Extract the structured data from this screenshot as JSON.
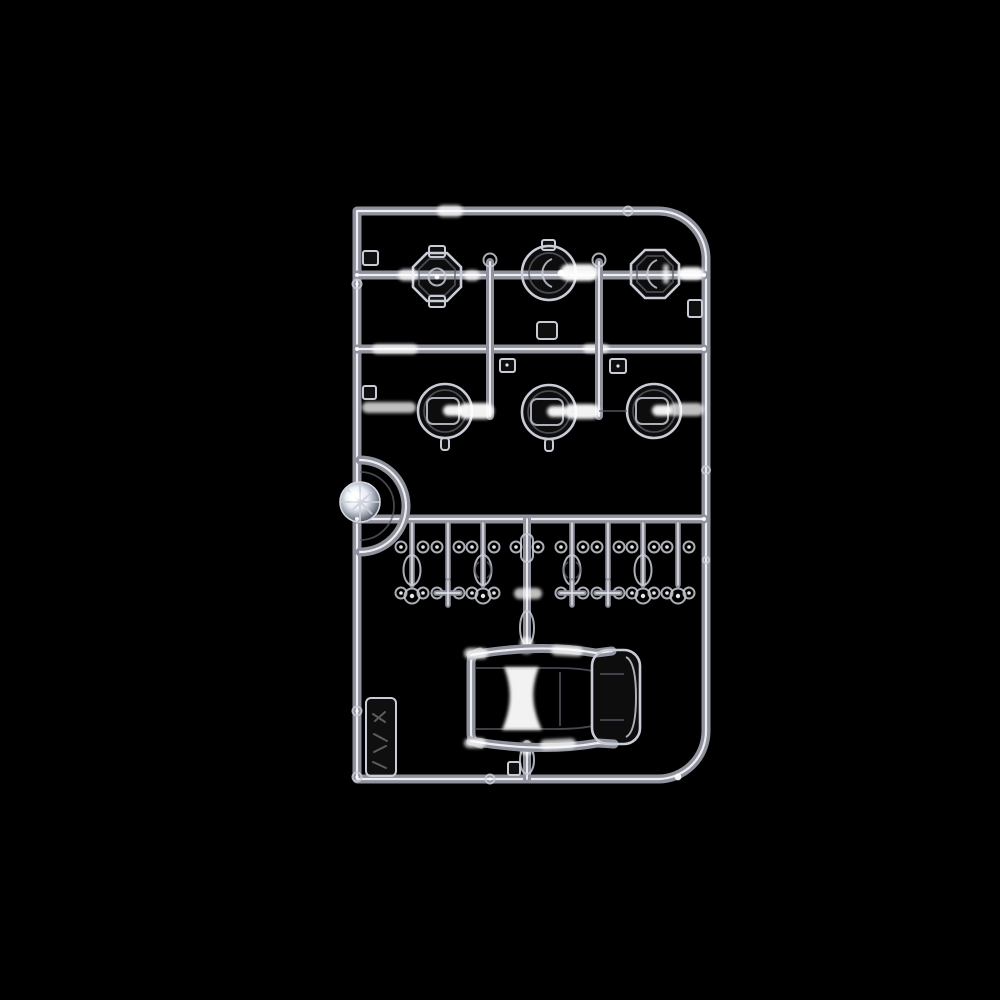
{
  "meta": {
    "kind": "product-photograph",
    "subject": "clear transparent injection-molded model-kit parts sprue (runner) photographed on a black background",
    "canvas": {
      "width_px": 1000,
      "height_px": 1000
    },
    "visible_text": "none (only illegible embossed marks on the molded tag)"
  },
  "palette": {
    "background": "#000000",
    "tube_outer": "#8f919d",
    "tube_inner": "#ffffff",
    "lens_stroke": "#c9ccd6",
    "faint": "#5d5f6a",
    "highlight": "#ffffff"
  },
  "sprue": {
    "material": "clear polystyrene, appears as white/grey outlines and specular highlights on black",
    "frame": {
      "shape": "rectangular runner frame",
      "rounded_corners": [
        "top-right",
        "bottom-right"
      ],
      "square_corners": [
        "top-left",
        "bottom-left"
      ]
    },
    "parts_inventory": [
      {
        "id": "octagonal-round-lens",
        "location": "top row (positions 1 and 3)",
        "count": 2
      },
      {
        "id": "circular-lens-with-crescent",
        "location": "top row (position 2)",
        "count": 1
      },
      {
        "id": "round-lens-with-square-insert",
        "location": "second row",
        "count": 3
      },
      {
        "id": "faceted-jewel-lens-with-ring",
        "location": "left edge, mid height",
        "count": 1
      },
      {
        "id": "small-marker-lens-bead",
        "location": "middle strip, two rows on hanging stems",
        "count": 16
      },
      {
        "id": "oval-lens",
        "location": "middle strip between bead rows",
        "count": 4
      },
      {
        "id": "one-piece-window-glazing-unit",
        "location": "bottom center",
        "count": 1
      },
      {
        "id": "molded-id-tag",
        "location": "bottom-left inside frame",
        "count": 1,
        "embossing": "illegible"
      }
    ]
  }
}
